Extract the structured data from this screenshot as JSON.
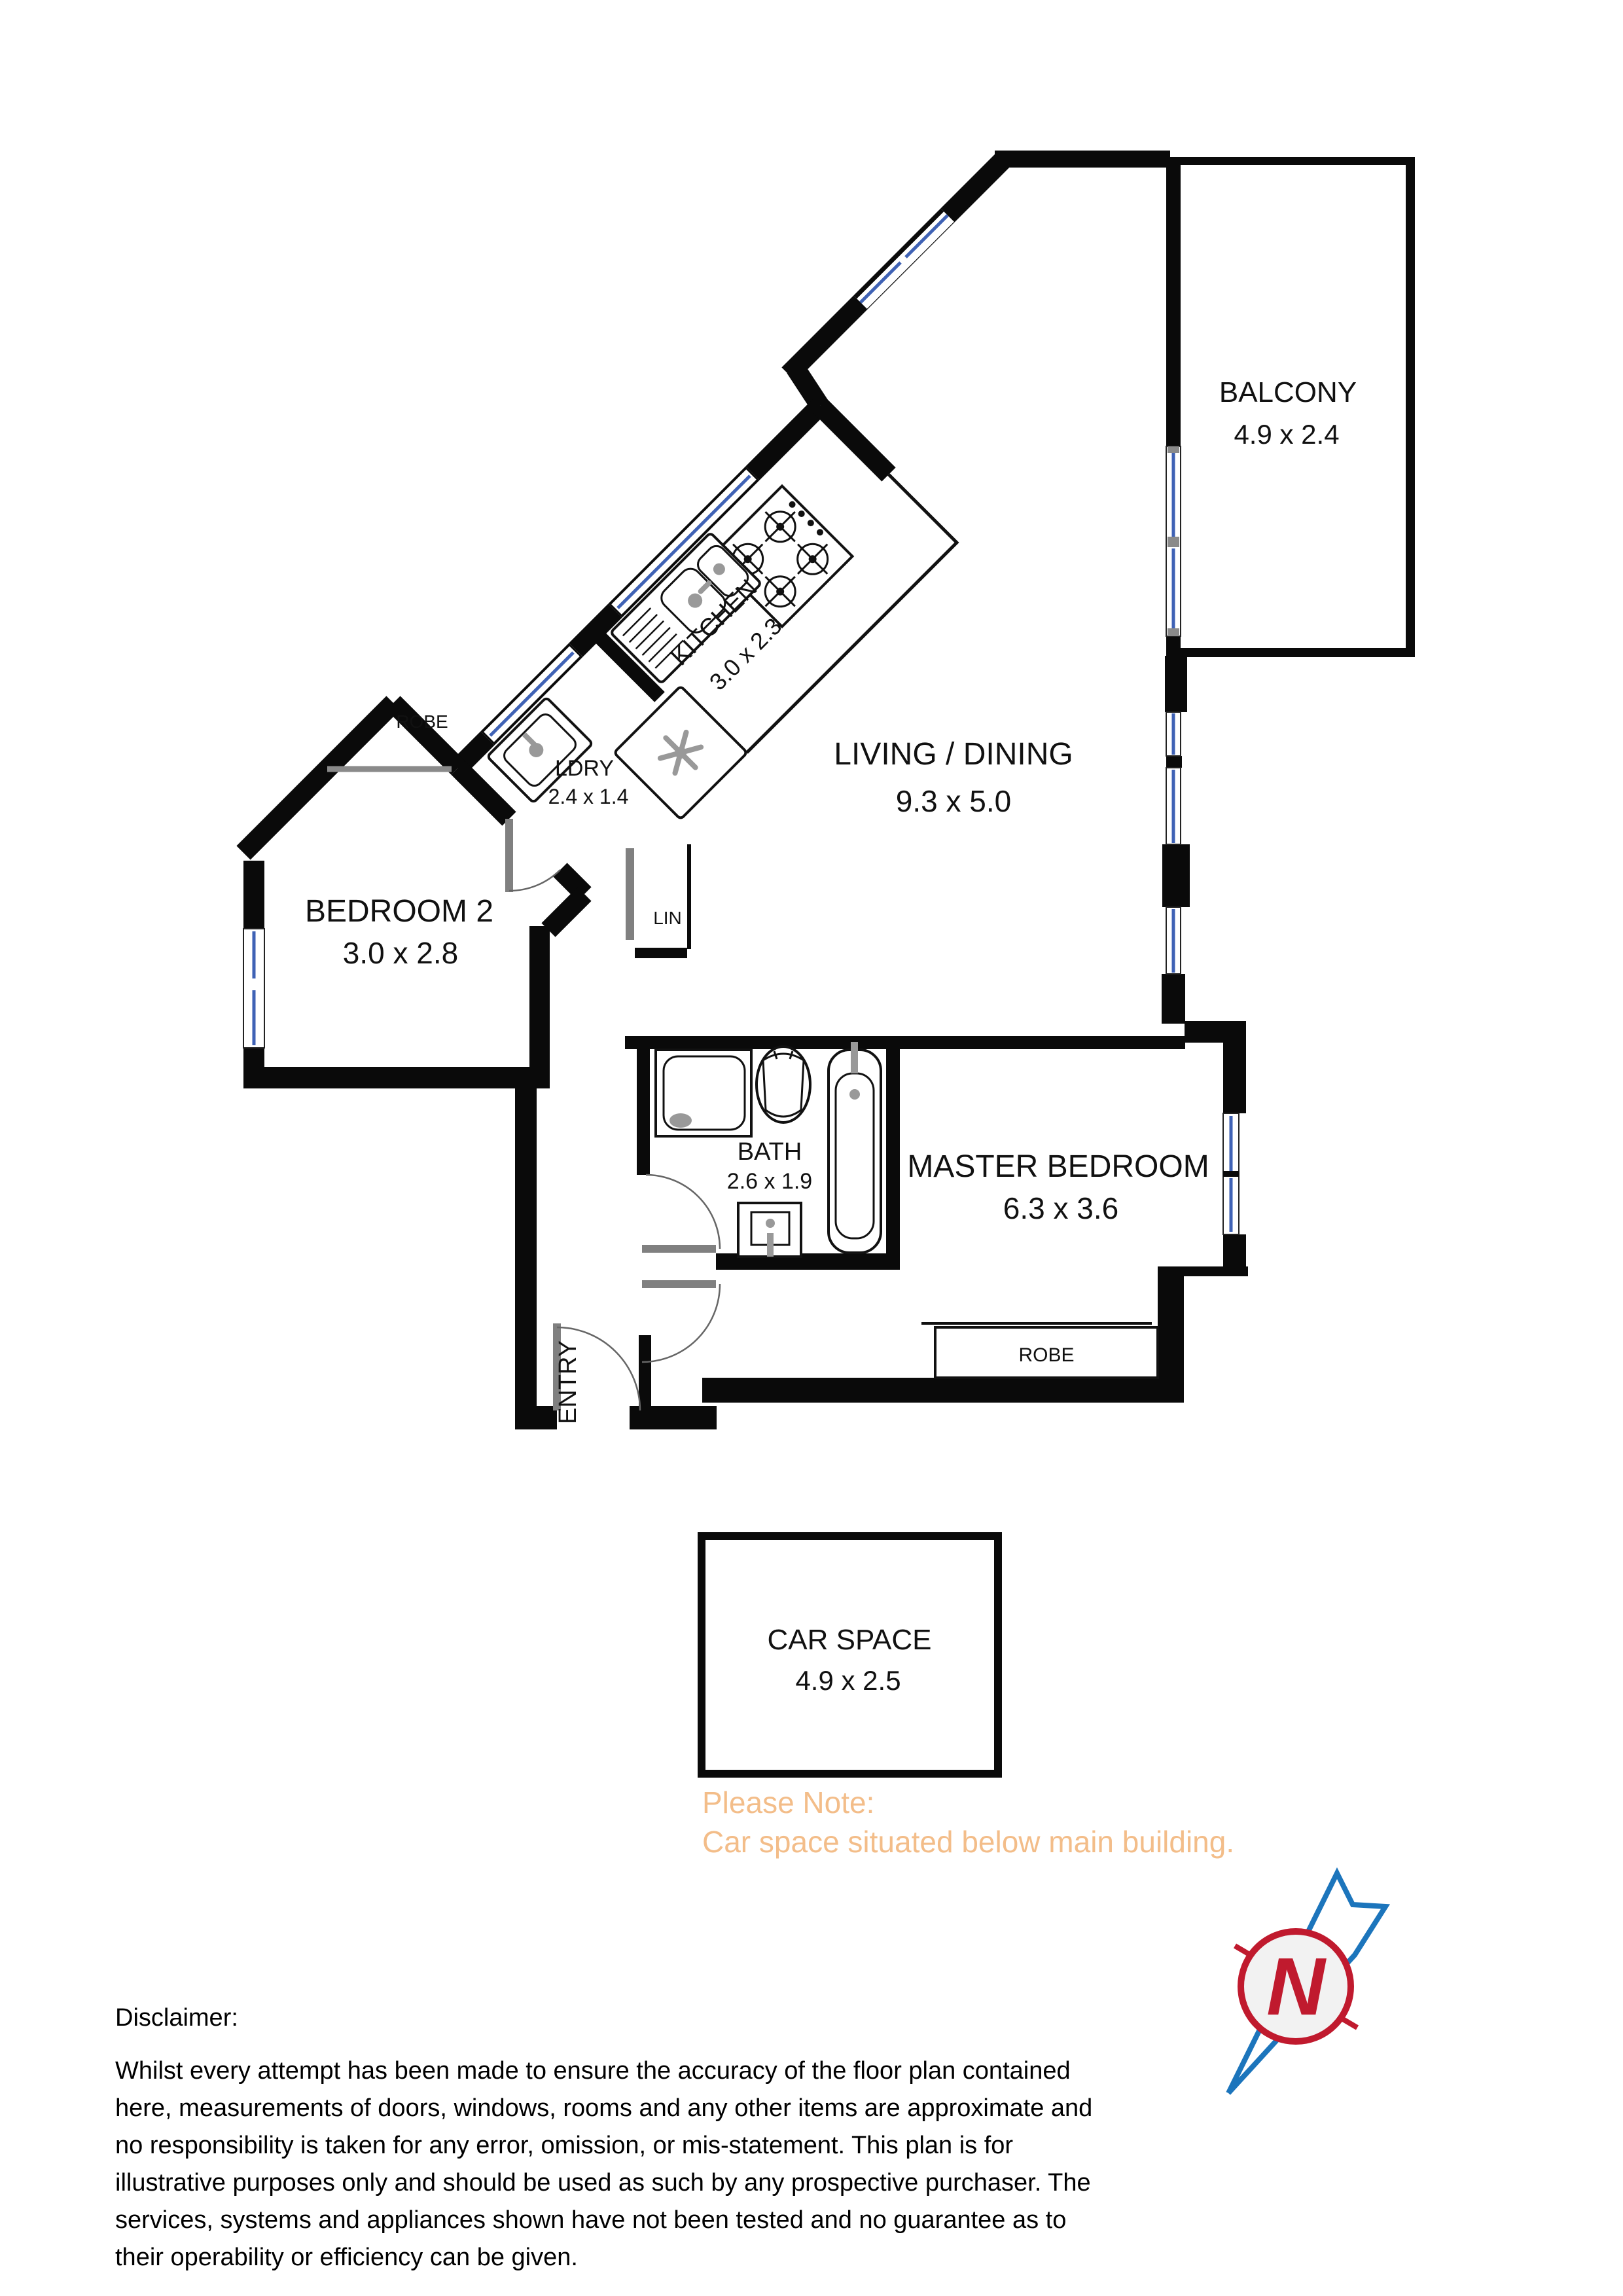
{
  "plan": {
    "balcony": {
      "name": "BALCONY",
      "dims": "4.9 x 2.4"
    },
    "kitchen": {
      "name": "KITCHEN",
      "dims": "3.0 x 2.3"
    },
    "laundry": {
      "name": "LDRY",
      "dims": "2.4 x 1.4"
    },
    "living": {
      "name": "LIVING / DINING",
      "dims": "9.3 x 5.0"
    },
    "bedroom2": {
      "name": "BEDROOM 2",
      "dims": "3.0 x 2.8"
    },
    "bath": {
      "name": "BATH",
      "dims": "2.6 x 1.9"
    },
    "master": {
      "name": "MASTER BEDROOM",
      "dims": "6.3 x 3.6"
    },
    "entry": {
      "name": "ENTRY"
    },
    "linen": {
      "name": "LIN"
    },
    "robe_bedroom2": {
      "name": "ROBE"
    },
    "robe_master": {
      "name": "ROBE"
    },
    "carspace": {
      "name": "CAR SPACE",
      "dims": "4.9 x 2.5"
    }
  },
  "note": {
    "title": "Please Note:",
    "body": "Car space situated below main building.",
    "color": "#f3bd89"
  },
  "disclaimer": {
    "title": "Disclaimer:",
    "lines": [
      "Whilst every attempt has been made to ensure the accuracy of the floor plan contained",
      "here, measurements of doors, windows, rooms and any other items are approximate and",
      "no responsibility is taken for any error, omission, or mis-statement. This plan is for",
      "illustrative purposes only and should be used as such by any prospective purchaser. The",
      "services, systems and appliances shown have not been tested and no guarantee as to",
      "their operability or efficiency can be given."
    ]
  },
  "compass": {
    "letter": "N"
  },
  "colors": {
    "wall": "#0a0a0a",
    "window_blue": "#3f62b5",
    "door_gray": "#808080",
    "note_orange": "#f3bd89",
    "compass_red": "#c01a2e",
    "compass_blue": "#1c75bc"
  }
}
